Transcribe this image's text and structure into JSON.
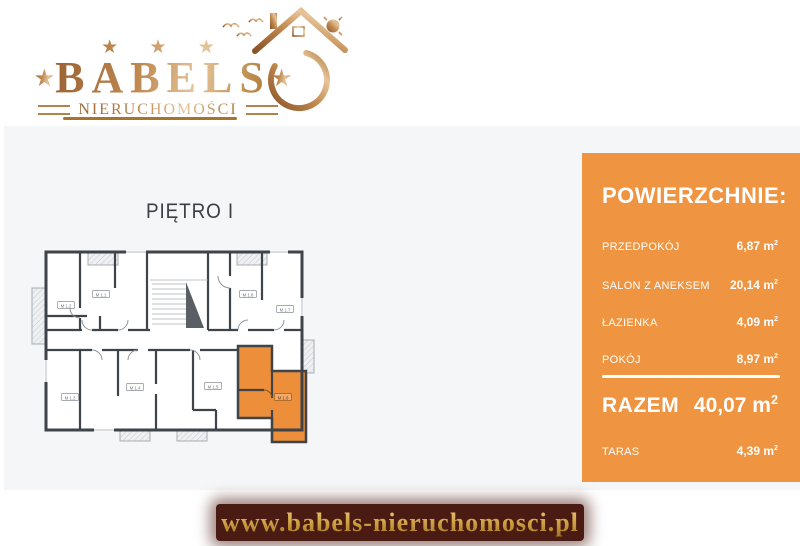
{
  "logo": {
    "stars_row": "★ ★ ★",
    "star_left": "★",
    "brand": "BABELS",
    "star_right": "★",
    "subtitle": "NIERUCHOMOŚCI",
    "gold_color": "#b07a45"
  },
  "plan": {
    "title": "PIĘTRO I",
    "highlight_color": "#EC8E3A",
    "units": [
      {
        "label": "M 1.1"
      },
      {
        "label": "M 1.2"
      },
      {
        "label": "M 1.3"
      },
      {
        "label": "M 1.4"
      },
      {
        "label": "M 1.5"
      },
      {
        "label": "M 1.6"
      },
      {
        "label": "M 1.7"
      },
      {
        "label": "M 1.8"
      }
    ]
  },
  "panel": {
    "bg_color": "#EF9440",
    "heading": "POWIERZCHNIE:",
    "rows": [
      {
        "label": "PRZEDPOKÓJ",
        "value": "6,87 m",
        "sup": "2"
      },
      {
        "label": "SALON Z ANEKSEM",
        "value": "20,14 m",
        "sup": "2"
      },
      {
        "label": "ŁAZIENKA",
        "value": "4,09 m",
        "sup": "2"
      },
      {
        "label": "POKÓJ",
        "value": "8,97 m",
        "sup": "2"
      }
    ],
    "total": {
      "label": "RAZEM",
      "value": "40,07 m",
      "sup": "2"
    },
    "extra": {
      "label": "TARAS",
      "value": "4,39 m",
      "sup": "2"
    }
  },
  "footer": {
    "url": "www.babels-nieruchomosci.pl",
    "banner_color": "#4A1B13"
  }
}
